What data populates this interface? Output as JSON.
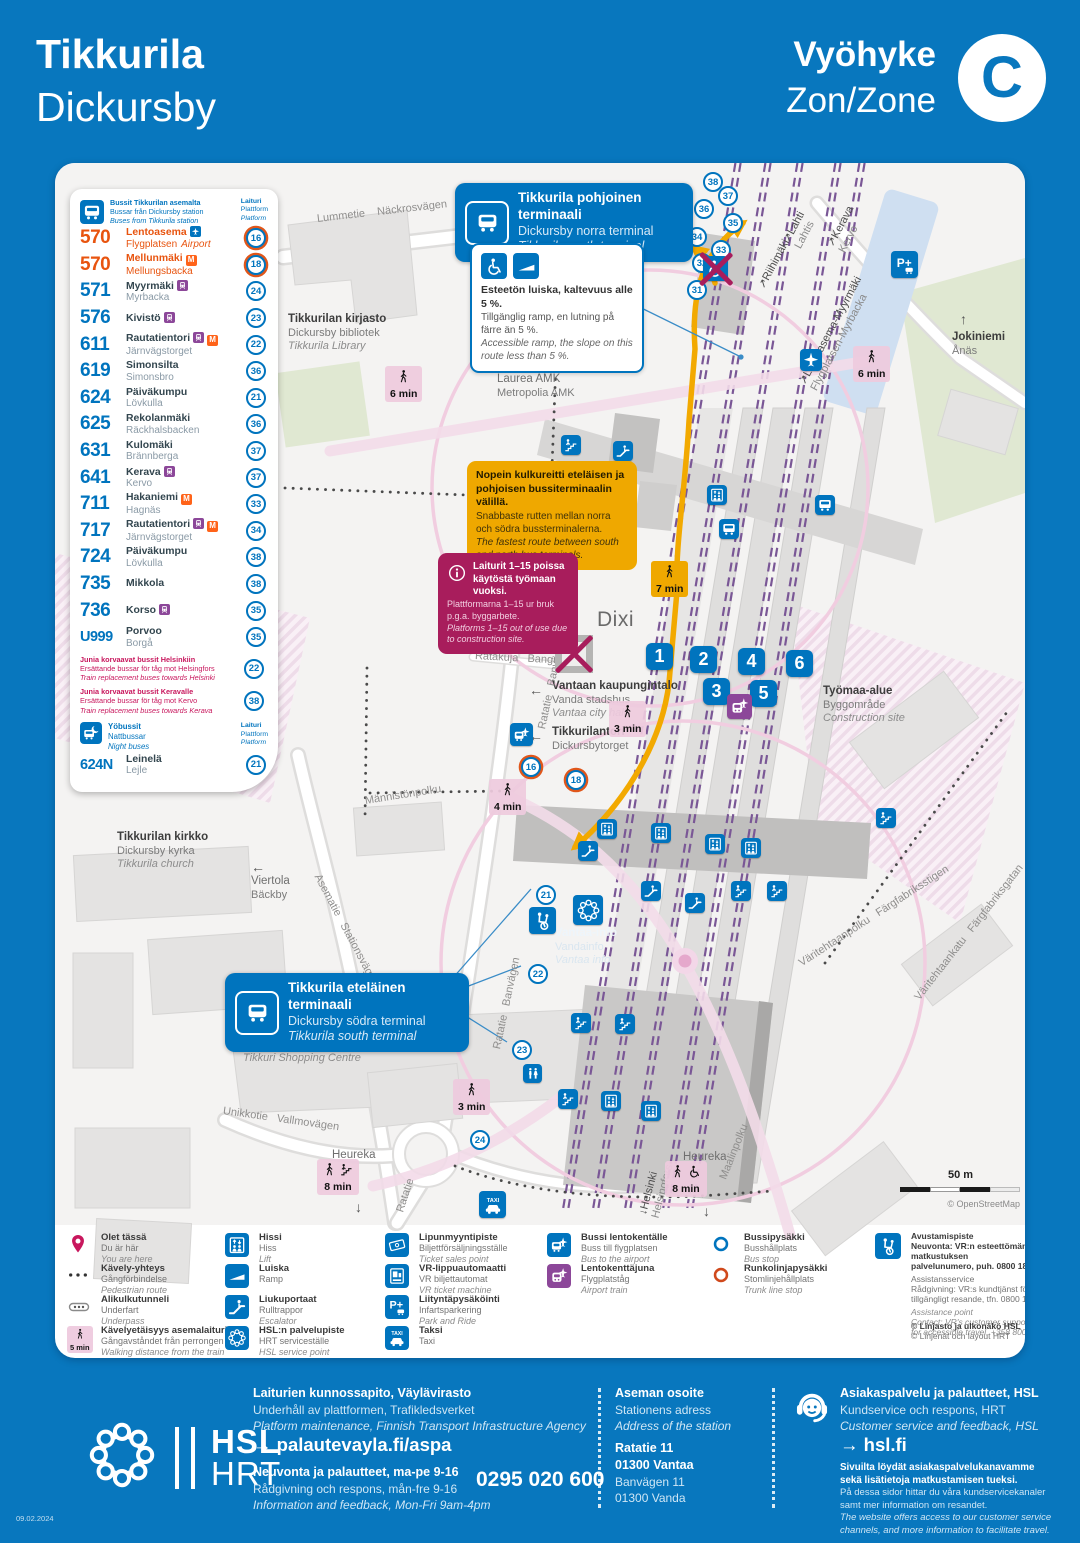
{
  "header": {
    "title_fi": "Tikkurila",
    "title_sv": "Dickursby",
    "zone_fi": "Vyöhyke",
    "zone_sv": "Zon/Zone",
    "zone_letter": "C"
  },
  "bus_panel": {
    "title": [
      "Bussit Tikkurilan asemalta",
      "Bussar från Dickursby station",
      "Buses from Tikkurila station"
    ],
    "platform_header": [
      "Laituri",
      "Plattform",
      "Platform"
    ],
    "routes": [
      {
        "num": "570",
        "color": "orange",
        "fi": "Lentoasema",
        "sv": "Flygplatsen",
        "en": "Airport",
        "badges": [
          "airport"
        ],
        "platform": "16",
        "ring": true
      },
      {
        "num": "570",
        "color": "orange",
        "fi": "Mellunmäki",
        "sv": "Mellungsbacka",
        "badges": [
          "metro"
        ],
        "platform": "18",
        "ring": true
      },
      {
        "num": "571",
        "fi": "Myyrmäki",
        "sv": "Myrbacka",
        "badges": [
          "train"
        ],
        "platform": "24"
      },
      {
        "num": "576",
        "fi": "Kivistö",
        "sv": "",
        "badges": [
          "train"
        ],
        "platform": "23"
      },
      {
        "num": "611",
        "fi": "Rautatientori",
        "sv": "Järnvägstorget",
        "badges": [
          "train",
          "metro"
        ],
        "platform": "22"
      },
      {
        "num": "619",
        "fi": "Simonsilta",
        "sv": "Simonsbro",
        "badges": [],
        "platform": "36"
      },
      {
        "num": "624",
        "fi": "Päiväkumpu",
        "sv": "Lövkulla",
        "badges": [],
        "platform": "21"
      },
      {
        "num": "625",
        "fi": "Rekolanmäki",
        "sv": "Räckhalsbacken",
        "badges": [],
        "platform": "36"
      },
      {
        "num": "631",
        "fi": "Kulomäki",
        "sv": "Brännberga",
        "badges": [],
        "platform": "37"
      },
      {
        "num": "641",
        "fi": "Kerava",
        "sv": "Kervo",
        "badges": [
          "train"
        ],
        "platform": "37"
      },
      {
        "num": "711",
        "fi": "Hakaniemi",
        "sv": "Hagnäs",
        "badges": [
          "metro"
        ],
        "platform": "33"
      },
      {
        "num": "717",
        "fi": "Rautatientori",
        "sv": "Järnvägstorget",
        "badges": [
          "train",
          "metro"
        ],
        "platform": "34"
      },
      {
        "num": "724",
        "fi": "Päiväkumpu",
        "sv": "Lövkulla",
        "badges": [],
        "platform": "38"
      },
      {
        "num": "735",
        "fi": "Mikkola",
        "sv": "",
        "badges": [],
        "platform": "38"
      },
      {
        "num": "736",
        "fi": "Korso",
        "sv": "",
        "badges": [
          "train"
        ],
        "platform": "35"
      },
      {
        "num": "U999",
        "fi": "Porvoo",
        "sv": "Borgå",
        "badges": [],
        "platform": "35"
      }
    ],
    "replacements": [
      {
        "fi": "Junia korvaavat bussit Helsinkiin",
        "sv": "Ersättande bussar för tåg mot Helsingfors",
        "en": "Train replacement buses towards Helsinki",
        "platform": "22"
      },
      {
        "fi": "Junia korvaavat bussit Keravalle",
        "sv": "Ersättande bussar för tåg mot Kervo",
        "en": "Train replacement buses towards Kerava",
        "platform": "38"
      }
    ],
    "night": {
      "title": [
        "Yöbussit",
        "Nattbussar",
        "Night buses"
      ],
      "platform_header": [
        "Laituri",
        "Plattform",
        "Platform"
      ],
      "routes": [
        {
          "num": "624N",
          "fi": "Leinelä",
          "sv": "Lejle",
          "badges": [],
          "platform": "21"
        }
      ]
    }
  },
  "callouts": {
    "north_terminal": {
      "fi": "Tikkurila pohjoinen terminaali",
      "sv": "Dickursby norra terminal",
      "en": "Tikkurila north terminal"
    },
    "ramp": {
      "fi": "Esteetön luiska, kaltevuus alle 5 %.",
      "sv": "Tillgänglig ramp, en lutning på färre än 5 %.",
      "en": "Accessible ramp, the slope on this route less than 5 %."
    },
    "fastest_route": {
      "fi": "Nopein kulkureitti eteläisen ja pohjoisen bussiterminaalin välillä.",
      "sv": "Snabbaste rutten mellan norra och södra bussterminalerna.",
      "en": "The fastest route between south and north bus terminals."
    },
    "platforms_closed": {
      "fi": "Laiturit 1–15 poissa käytöstä työmaan vuoksi.",
      "sv": "Plattformarna 1–15 ur bruk p.g.a. byggarbete.",
      "en": "Platforms 1–15 out of use due to construction site."
    },
    "south_terminal": {
      "fi": "Tikkurila eteläinen terminaali",
      "sv": "Dickursby södra terminal",
      "en": "Tikkurila south terminal"
    }
  },
  "map": {
    "labels": [
      {
        "id": "library",
        "lines": [
          "Tikkurilan kirjasto",
          "Dickursby bibliotek",
          "Tikkurila Library"
        ]
      },
      {
        "id": "laurea",
        "lines": [
          "Laurea AMK",
          "Metropolia AMK"
        ],
        "plain": true
      },
      {
        "id": "construction-west",
        "lines": [
          "Työmaa-alue",
          "Byggområde",
          "Construction site"
        ]
      },
      {
        "id": "construction-east",
        "lines": [
          "Työmaa-alue",
          "Byggområde",
          "Construction site"
        ]
      },
      {
        "id": "dixi",
        "lines": [
          "Dixi"
        ],
        "big": true
      },
      {
        "id": "city-hall",
        "lines": [
          "Vantaan kaupungintalo",
          "Vanda stadshus",
          "Vantaa city hall"
        ],
        "arrow": "←"
      },
      {
        "id": "tikkurilantori",
        "lines": [
          "Tikkurilantori",
          "Dickursbytorget"
        ],
        "arrow": "←"
      },
      {
        "id": "church",
        "lines": [
          "Tikkurilan kirkko",
          "Dickursby kyrka",
          "Tikkurila church"
        ]
      },
      {
        "id": "viertola",
        "lines": [
          "Viertola",
          "Bäckby"
        ],
        "arrow": "←",
        "plain": true
      },
      {
        "id": "shopping-centre",
        "lines": [
          "Kauppakeskus Tikkuri",
          "Köpcentrum Tikkuri",
          "Tikkuri Shopping Centre"
        ]
      },
      {
        "id": "jokiniemi",
        "lines": [
          "Jokiniemi",
          "Ånäs"
        ],
        "arrow": "↑"
      },
      {
        "id": "heureka-west",
        "lines": [
          "Heureka"
        ],
        "plain": true
      },
      {
        "id": "heureka-east",
        "lines": [
          "Heureka"
        ],
        "plain": true
      },
      {
        "id": "vantaa-info",
        "lines": [
          "Vantaa-info",
          "Vandainfo",
          "Vantaa info"
        ],
        "light": true
      }
    ],
    "track_labels": [
      {
        "id": "riihimaki",
        "lines": [
          "Riihimäki"
        ],
        "arrow": "↗"
      },
      {
        "id": "lahti",
        "lines": [
          "Lahti",
          "Lahtis"
        ],
        "arrow": "↗"
      },
      {
        "id": "kerava",
        "lines": [
          "Kerava",
          "Kervo"
        ],
        "arrow": "↗"
      },
      {
        "id": "ring-rail",
        "lines": [
          "Lentoasema-Myyrmäki",
          "Flygplatsen-Myrbacka"
        ],
        "arrow": "↗"
      },
      {
        "id": "helsinki",
        "lines": [
          "Helsinki",
          "Helsingfors"
        ],
        "arrow": "↓"
      }
    ],
    "streets": [
      {
        "id": "lummetie",
        "text": "Lummetie    Näckrosvägen"
      },
      {
        "id": "ratakuja",
        "text": "Ratakuja   Bangränden"
      },
      {
        "id": "ratatie-banvagen-n",
        "text": "Ratatie   Banvägen"
      },
      {
        "id": "mannistonpolku",
        "text": "Männistönpolku"
      },
      {
        "id": "asematie",
        "text": "Asematie   Stationsvägen"
      },
      {
        "id": "unikkotie",
        "text": "Unikkotie   Vallmovägen"
      },
      {
        "id": "ratatie-s",
        "text": "Ratatie"
      },
      {
        "id": "ratatie-banvagen-s",
        "text": "Ratatie   Banvägen"
      },
      {
        "id": "maalinpolku",
        "text": "Maalinpolku"
      },
      {
        "id": "varitehtaankatu",
        "text": "Väritehtaankatu   Färgfabriksgatan"
      },
      {
        "id": "varitehtaanpolku",
        "text": "Väritehtaanpolku   Färgfabriksstigen"
      }
    ],
    "walk_badges": [
      {
        "id": "library",
        "text": "6 min"
      },
      {
        "id": "northeast",
        "text": "6 min"
      },
      {
        "id": "bridge",
        "text": "7 min",
        "style": "yellow"
      },
      {
        "id": "center",
        "text": "3 min"
      },
      {
        "id": "mannisto",
        "text": "4 min"
      },
      {
        "id": "south",
        "text": "3 min"
      },
      {
        "id": "heureka-west",
        "text": "8 min",
        "extra": "stairs"
      },
      {
        "id": "heureka-east",
        "text": "8 min",
        "extra": "wheelchair"
      }
    ],
    "platform_chips": [
      "1",
      "2",
      "3",
      "4",
      "5",
      "6"
    ],
    "platform_circles": [
      {
        "n": "31"
      },
      {
        "n": "32"
      },
      {
        "n": "33"
      },
      {
        "n": "34"
      },
      {
        "n": "35"
      },
      {
        "n": "36"
      },
      {
        "n": "37"
      },
      {
        "n": "38"
      },
      {
        "n": "16",
        "ring": true
      },
      {
        "n": "18",
        "ring": true
      },
      {
        "n": "21"
      },
      {
        "n": "22"
      },
      {
        "n": "23"
      },
      {
        "n": "24"
      }
    ],
    "facilities": [
      "lift",
      "escalator",
      "stairs",
      "assistance-point",
      "wc",
      "vantaa-info-point",
      "taxi",
      "airport-train",
      "bus-to-airport",
      "park-and-ride",
      "airport",
      "accessible-entrance-closed",
      "station-entrance-closed",
      "bus-stop"
    ],
    "scale": {
      "label": "50 m",
      "attribution": "© OpenStreetMap"
    }
  },
  "legend": {
    "columns": [
      {
        "items": [
          {
            "icon": "pin",
            "lines": [
              "Olet tässä",
              "Du är här",
              "You are here"
            ]
          },
          {
            "icon": "dots",
            "lines": [
              "Kävely-yhteys",
              "Gångförbindelse",
              "Pedestrian route"
            ]
          },
          {
            "icon": "underpass",
            "lines": [
              "Alikulkutunneli",
              "Underfart",
              "Underpass"
            ]
          },
          {
            "icon": "walkbadge",
            "lines": [
              "Kävelyetäisyys asemalaiturilta",
              "Gångavståndet från perrongen",
              "Walking distance from the train platform"
            ]
          }
        ]
      },
      {
        "items": [
          {
            "icon": "lift",
            "lines": [
              "Hissi",
              "Hiss",
              "Lift"
            ]
          },
          {
            "icon": "ramp",
            "lines": [
              "Luiska",
              "Ramp"
            ]
          },
          {
            "icon": "escalator",
            "lines": [
              "Liukuportaat",
              "Rulltrappor",
              "Escalator"
            ]
          },
          {
            "icon": "flower",
            "lines": [
              "HSL:n palvelupiste",
              "HRT serviceställe",
              "HSL service point"
            ]
          }
        ]
      },
      {
        "items": [
          {
            "icon": "ticket",
            "lines": [
              "Lipunmyyntipiste",
              "Biljettförsäljningsställe",
              "Ticket sales point"
            ]
          },
          {
            "icon": "vr",
            "lines": [
              "VR-lippuautomaatti",
              "VR biljettautomat",
              "VR ticket machine"
            ]
          },
          {
            "icon": "parkride",
            "lines": [
              "Liityntäpysäköinti",
              "Infartsparkering",
              "Park and Ride"
            ]
          },
          {
            "icon": "taxi",
            "lines": [
              "Taksi",
              "Taxi"
            ]
          }
        ]
      },
      {
        "items": [
          {
            "icon": "busplane",
            "lines": [
              "Bussi lentokentälle",
              "Buss till flygplatsen",
              "Bus to the airport"
            ]
          },
          {
            "icon": "trainplane",
            "lines": [
              "Lentokenttäjuna",
              "Flygplatståg",
              "Airport train"
            ]
          }
        ]
      },
      {
        "items": [
          {
            "icon": "stop-blue",
            "lines": [
              "Bussipysäkki",
              "Busshållplats",
              "Bus stop"
            ]
          },
          {
            "icon": "stop-orange",
            "lines": [
              "Runkolinjapysäkki",
              "Stomlinjehållplats",
              "Trunk line stop"
            ]
          }
        ]
      }
    ],
    "walk_badge_label": "5 min",
    "assistance": {
      "bold": [
        "Avustamispiste",
        "Neuvonta: VR:n esteettömän matkustuksen",
        "palvelunumero, puh. 0800 188 822"
      ],
      "normal": [
        "Assistansservice",
        "Rådgivning: VR:s kundtjänst för",
        "tillgängligt resande, tfn. 0800 188 822"
      ],
      "italic": [
        "Assistance point",
        "Contact: VR's customer support",
        "for accessible travel, +358 800 188 822"
      ]
    },
    "copyright": [
      "© Linjasto ja ulkonäkö HSL",
      "© Linjenät och layout HRT"
    ]
  },
  "footer": {
    "logo": {
      "line1": "HSL",
      "line2": "HRT"
    },
    "maintenance": [
      "Laiturien kunnossapito, Väylävirasto",
      "Underhåll av plattformen, Trafikledsverket",
      "Platform maintenance, Finnish Transport Infrastructure Agency"
    ],
    "feedback_link": "→ palautevayla.fi/aspa",
    "info_lines": [
      "Neuvonta ja palautteet, ma-pe 9-16",
      "Rådgivning och respons, mån-fre 9-16",
      "Information and feedback, Mon-Fri 9am-4pm"
    ],
    "phone": "0295 020 600",
    "address": {
      "head": [
        "Aseman osoite",
        "Stationens adress",
        "Address of the station"
      ],
      "lines": [
        "Ratatie 11",
        "01300 Vantaa",
        "Banvägen 11",
        "01300 Vanda"
      ]
    },
    "service": {
      "head": [
        "Asiakaspalvelu ja palautteet, HSL",
        "Kundservice och respons, HRT",
        "Customer service and feedback, HSL"
      ],
      "link": "→ hsl.fi",
      "body": [
        "Sivuilta löydät asiakaspalvelukanavamme",
        "sekä lisätietoja matkustamisen tueksi.",
        "På dessa sidor hittar du våra kundservicekanaler",
        "samt mer information om resandet.",
        "The website offers access to our customer service",
        "channels, and more information to facilitate travel."
      ]
    },
    "date": "09.02.2024"
  },
  "colors": {
    "hsl_blue": "#0074BE",
    "page_blue": "#0877BE",
    "orange": "#E8540F",
    "metro_orange": "#FF6319",
    "train_purple": "#8C4799",
    "crimson": "#C8175D",
    "callout_red": "#A81D5C",
    "route_yellow": "#F2A900",
    "walk_pink": "#EECADE"
  }
}
